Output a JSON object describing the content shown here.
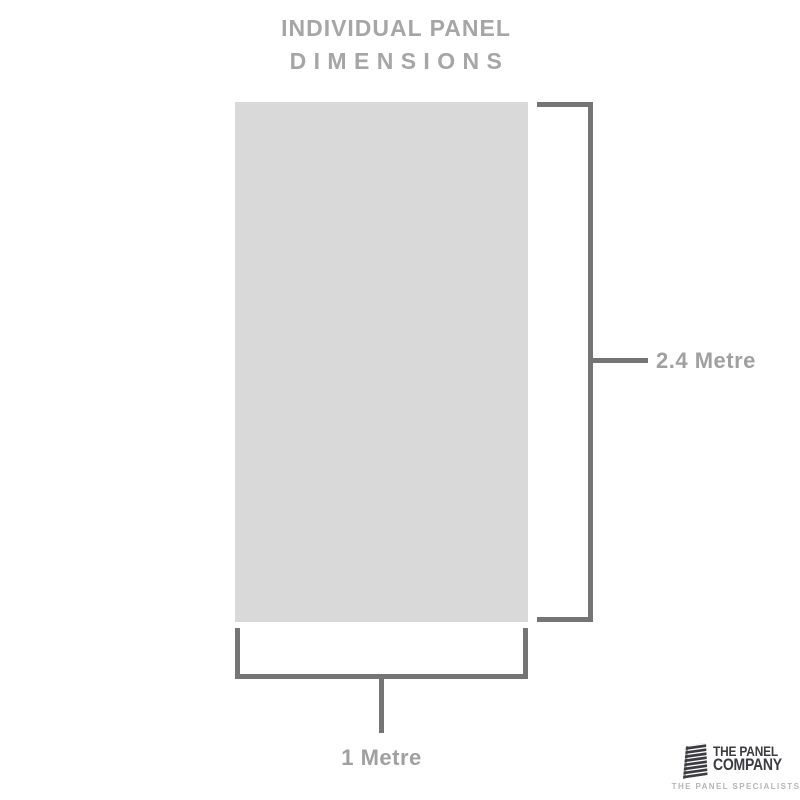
{
  "title": {
    "line1": "INDIVIDUAL PANEL",
    "line2": "D I M E N S I O N S"
  },
  "dimensions": {
    "height_label": "2.4 Metre",
    "width_label": "1 Metre"
  },
  "logo": {
    "company_line1": "THE PANEL",
    "company_line2": "COMPANY",
    "tagline": "THE PANEL SPECIALISTS",
    "icon": "stacked-panels-icon"
  },
  "colors": {
    "background": "#ffffff",
    "panel_fill": "#d9d9d9",
    "bracket": "#757575",
    "dimension_label": "#a0a0a0",
    "title_text": "#a6a6a6",
    "logo_dark": "#3b3b40",
    "tagline_text": "#b5b5b5"
  }
}
